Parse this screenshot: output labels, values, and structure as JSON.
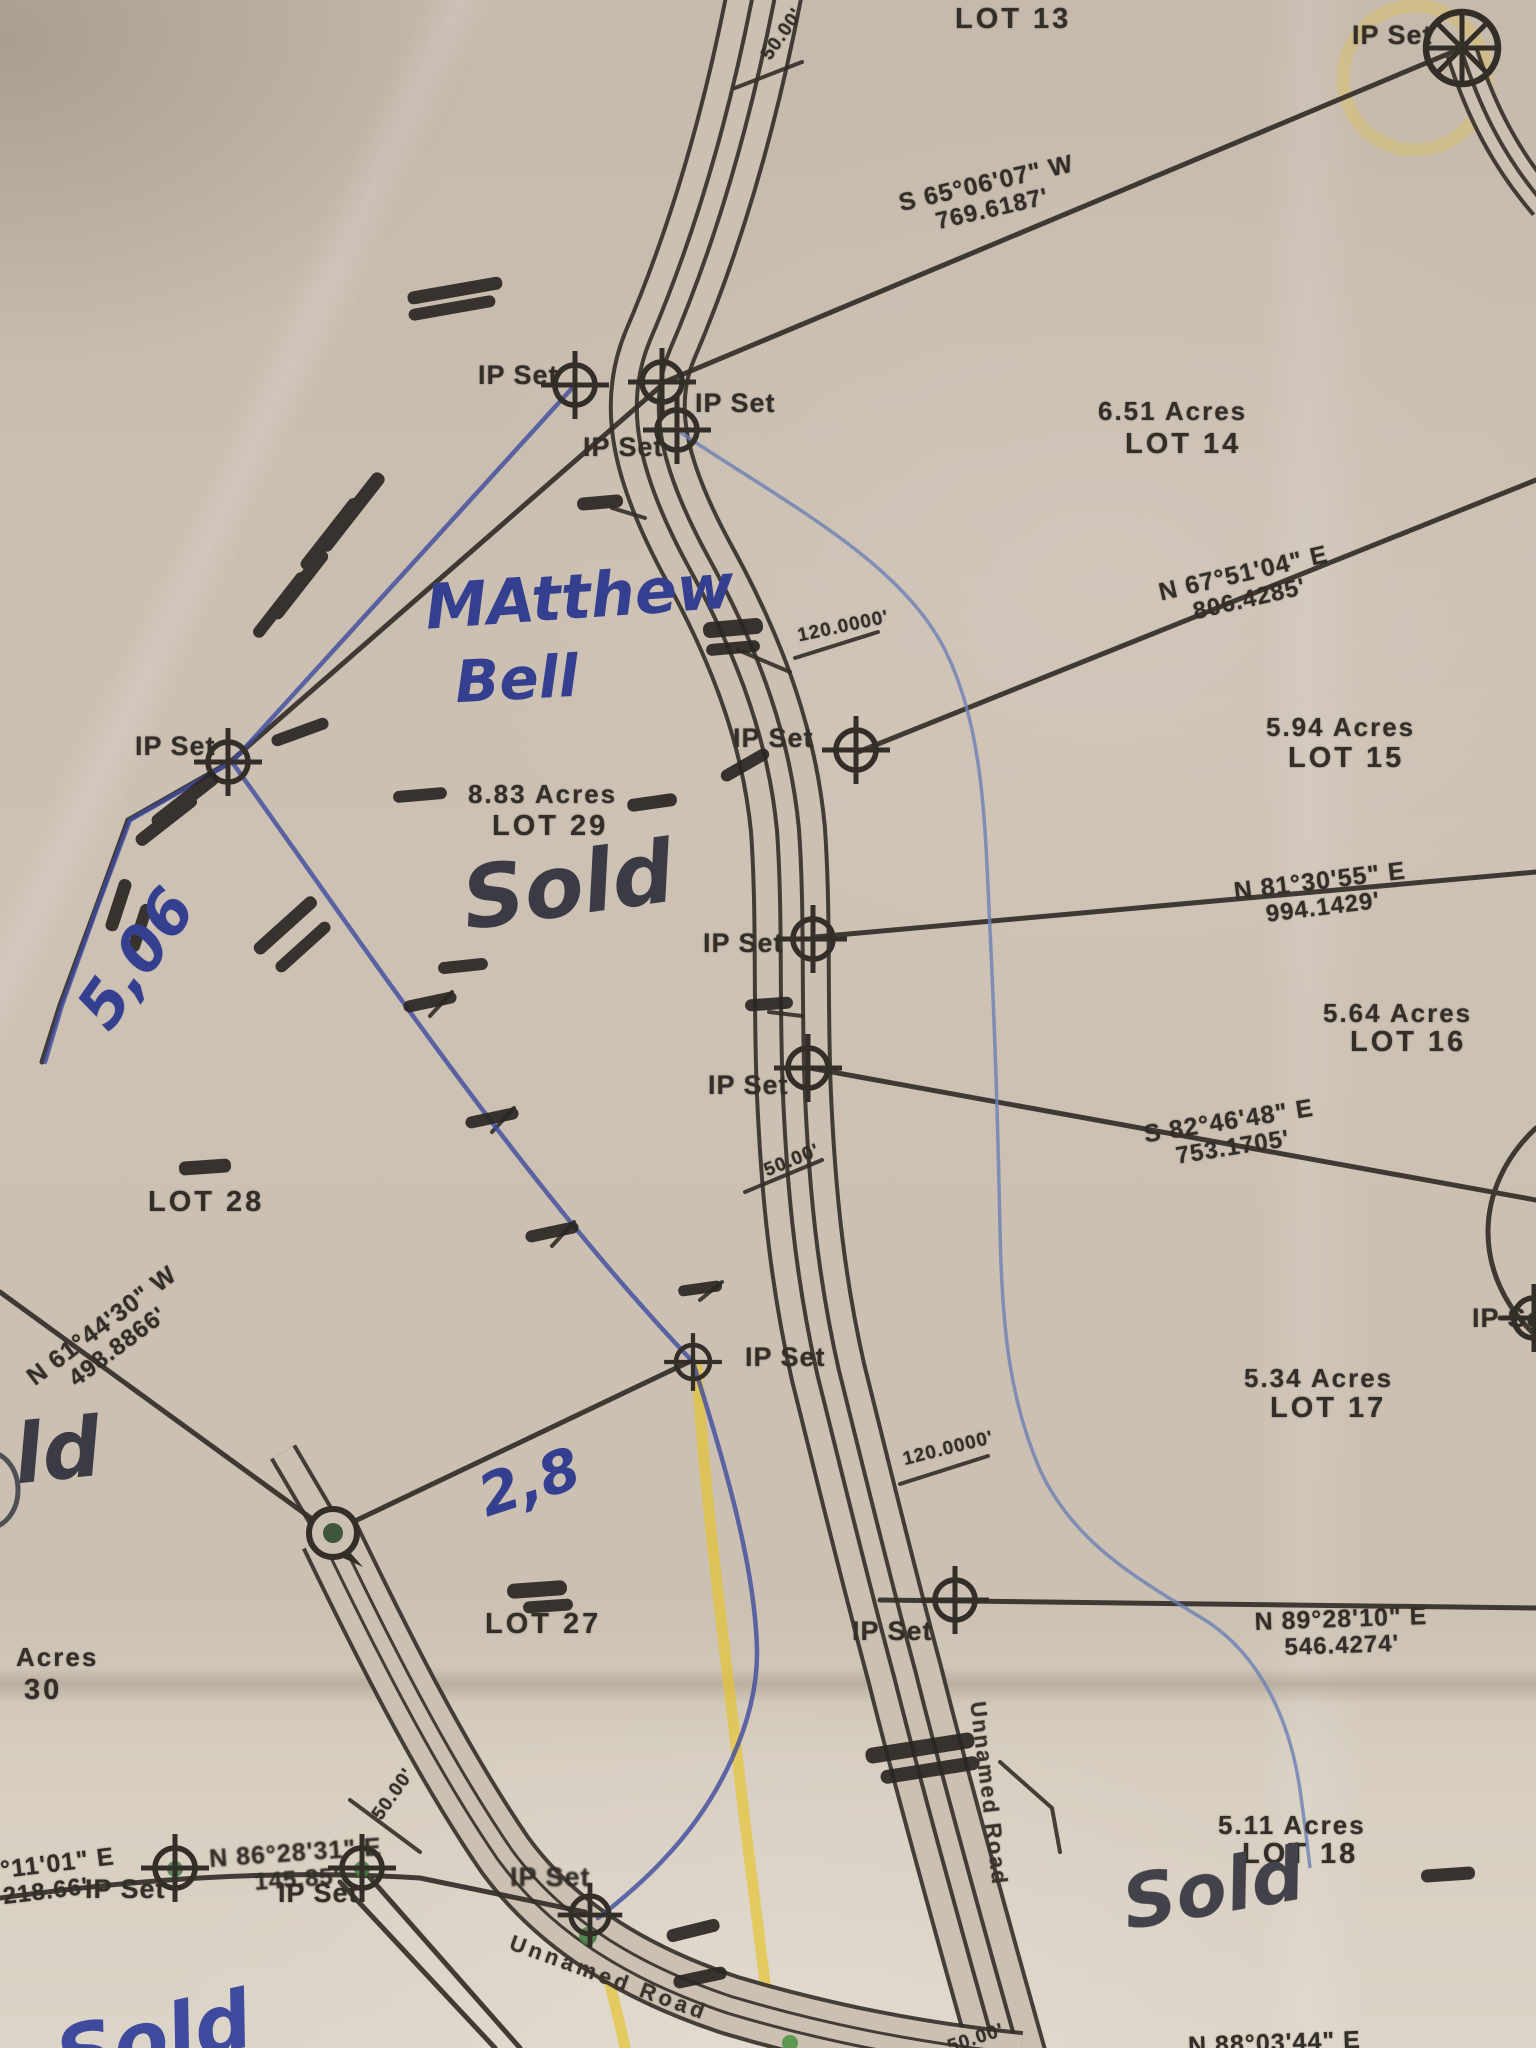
{
  "labels": {
    "ip_set": "IP Set",
    "unnamed_road": "Unnamed Road",
    "fifty_feet": "50.00'",
    "one_twenty": "120.0000'"
  },
  "lots": {
    "lot13": {
      "name": "LOT 13"
    },
    "lot14": {
      "acres": "6.51 Acres",
      "name": "LOT 14"
    },
    "lot15": {
      "acres": "5.94 Acres",
      "name": "LOT 15"
    },
    "lot16": {
      "acres": "5.64 Acres",
      "name": "LOT 16"
    },
    "lot17": {
      "acres": "5.34 Acres",
      "name": "LOT 17"
    },
    "lot18": {
      "acres": "5.11 Acres",
      "name": "LOT 18"
    },
    "lot27": {
      "name": "LOT 27"
    },
    "lot28": {
      "name": "LOT 28"
    },
    "lot29": {
      "acres": "8.83 Acres",
      "name": "LOT 29"
    },
    "lot30": {
      "acres_partial": "Acres",
      "name": "30"
    }
  },
  "bearings": {
    "lot13_lot14": {
      "dir": "S 65°06'07\" W",
      "dist": "769.6187'"
    },
    "lot14_lot15": {
      "dir": "N 67°51'04\" E",
      "dist": "806.4285'"
    },
    "lot15_lot16": {
      "dir": "N 81°30'55\" E",
      "dist": "994.1429'"
    },
    "lot16_lot17": {
      "dir": "S 82°46'48\" E",
      "dist": "753.1705'"
    },
    "lot17_lot18": {
      "dir": "N 89°28'10\" E",
      "dist": "546.4274'"
    },
    "west_line": {
      "dir": "N 61°44'30\" W",
      "dist": "498.8866'"
    },
    "south_line_partial": {
      "dir": "82°11'01\" E",
      "dist": "218.66'"
    },
    "south_line_2": {
      "dir": "N 86°28'31\" E",
      "dist": "145.85'"
    },
    "bottom_edge_partial": {
      "dir": "N 88°03'44\" E"
    }
  },
  "handwriting": {
    "owner_line1": "MAtthew",
    "owner_line2": "Bell",
    "sold_lot29": "Sold",
    "sold_lot18": "Sold",
    "sold_left_partial": "ld",
    "sold_bottom_left": "Sold",
    "acreage_note_1": "5,06",
    "acreage_note_2": "2,8"
  },
  "colors": {
    "paper": "#cdc1b3",
    "print_ink": "#332e28",
    "blue_pen": "#3d4a9e",
    "dark_pen": "#3b3b45",
    "highlighter_yellow": "#e6c432",
    "marker_green": "#3f7a3f",
    "stream_blue": "#6b7fb5"
  }
}
